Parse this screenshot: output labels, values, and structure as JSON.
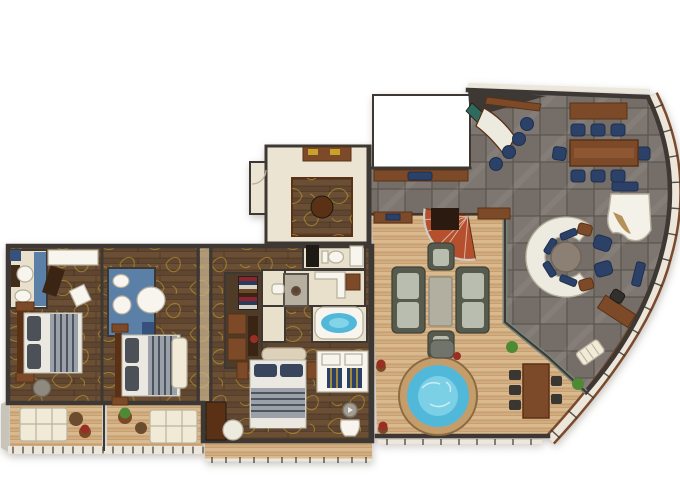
{
  "meta": {
    "type": "floor-plan",
    "description": "luxury-ship-suite-floor-plan"
  },
  "rooms": [
    {
      "id": "entrance-foyer"
    },
    {
      "id": "galley-void"
    },
    {
      "id": "dining-lounge"
    },
    {
      "id": "living-room"
    },
    {
      "id": "private-deck"
    },
    {
      "id": "master-bedroom"
    },
    {
      "id": "master-bathroom"
    },
    {
      "id": "walk-in-closet"
    },
    {
      "id": "powder-room"
    },
    {
      "id": "guest-bedroom-1"
    },
    {
      "id": "guest-bathroom-1"
    },
    {
      "id": "guest-bedroom-2"
    },
    {
      "id": "guest-bathroom-2"
    },
    {
      "id": "balcony-1"
    },
    {
      "id": "balcony-2"
    },
    {
      "id": "master-balcony"
    }
  ],
  "palette": {
    "wall": "#3d3833",
    "band": "#ece7da",
    "hull": "#7a4a2e",
    "tile": "#7e7771",
    "tile2": "#756e68",
    "grout": "#5a554e",
    "darkwood": "#6b4f35",
    "darkwood2": "#5f4630",
    "plankline": "rgba(40,22,8,0.33)",
    "deck": "#dab98e",
    "deck2": "#d0ac7e",
    "deckline": "rgba(150,104,58,0.35)",
    "cream": "#ece4d2",
    "bathcream": "#e8e0ca",
    "bathblue": "#5b80a8",
    "bathblue2": "#36517b",
    "navy": "#2c4168",
    "navy2": "#1e2f4e",
    "gold": "#c9a22c",
    "stairred": "#b5502e",
    "stairdark": "#2a1a10",
    "sofa": "#575b4e",
    "cushion": "#b8bdb0",
    "graytable": "#b2afa1",
    "csofa": "#edebdf",
    "brown": "#7c4a28",
    "brown2": "#5a3115",
    "piano": "#f4f1e8",
    "pianogold": "#a97f3e",
    "water": "#52b8da",
    "water2": "#9adfef",
    "tubring": "#c59d6b",
    "white": "#f7f5ed",
    "fixline": "#b5ae9c",
    "green": "#4e8a34",
    "red": "#992e24",
    "pot": "#7a4a28",
    "glass": "#75847a",
    "black": "#1d1a16",
    "blanket": "#9ba1a9",
    "stripe": "#4e545d",
    "pillow1": "#4c5158",
    "pillow2": "#39455c",
    "sheet": "#eae8e0",
    "hbcream": "#ddd1b9",
    "lounger": "#f0ead7",
    "closetfloor": "#4e3b28",
    "shower": "#b7b0a1",
    "teal": "#2e6b5e",
    "speaker": "#a39c91",
    "runner": "#c7b18c",
    "hullgray": "#c9c4ba",
    "clothes": [
      "#8b2430",
      "#2c3a5a",
      "#d8d4c8",
      "#6b4a2a",
      "#3a2414",
      "#8b2430",
      "#2c3a5a",
      "#d8d4c8"
    ]
  }
}
